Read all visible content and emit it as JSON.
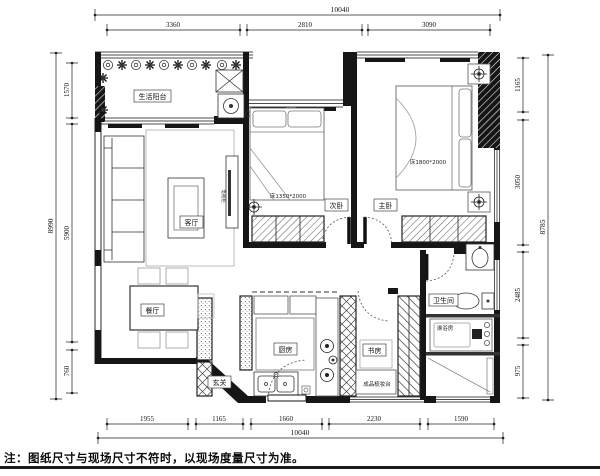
{
  "note": "注：图纸尺寸与现场尺寸不符时，以现场度量尺寸为准。",
  "colors": {
    "ink": "#161616",
    "paper": "#ffffff",
    "furniture_line": "#4a4a4a"
  },
  "rooms": {
    "balcony": "生活阳台",
    "living": "客厅",
    "dining": "餐厅",
    "entry": "玄关",
    "kitchen": "厨房",
    "bedroom2": "次卧",
    "master": "主卧",
    "study": "书房",
    "bathroom": "卫生间",
    "shower": "淋浴房",
    "dresser": "成品梳妆台",
    "tv_cabinet": "电视柜",
    "bed2_label": "床1350*2000",
    "master_bed_label": "床1800*2000"
  },
  "dimensions": {
    "top": {
      "total": "10040",
      "segments": [
        "3360",
        "2810",
        "3090"
      ]
    },
    "bottom": {
      "total": "10040",
      "segments": [
        "1955",
        "1165",
        "1660",
        "2230",
        "1590"
      ]
    },
    "left": {
      "total": "8990",
      "segments": [
        "1570",
        "5900",
        "760"
      ]
    },
    "right": {
      "total": "8785",
      "segments": [
        "1165",
        "3050",
        "2485",
        "975"
      ]
    }
  }
}
